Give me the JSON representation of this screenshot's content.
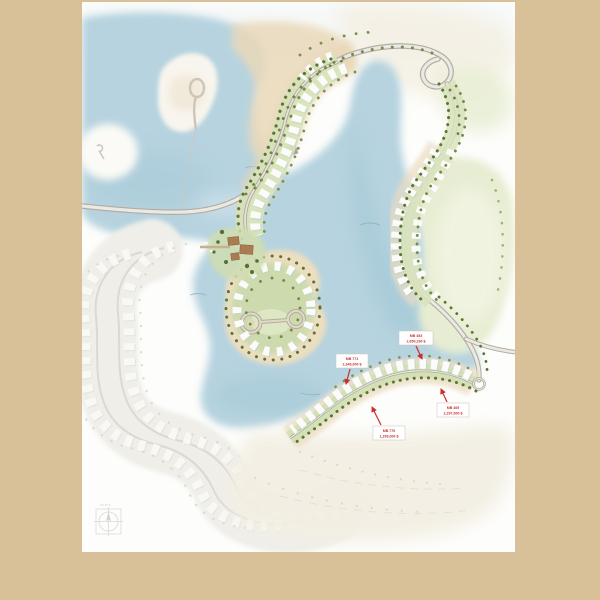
{
  "map": {
    "kind": "resort-master-plan",
    "palette": {
      "frame": "#d8c198",
      "sheet": "#fdfdfb",
      "water": "#b6d3df",
      "water_deep": "#a3c7d5",
      "sand": "#ead9ba",
      "green_band": "#d6e1ba",
      "golf": "#e7edd2",
      "road": "#b2ada3",
      "tree": "#5e7336",
      "ghost": "#efeee9",
      "label_red": "#c92f2f",
      "clubhouse_brown": "#a97c52"
    },
    "price_labels": [
      {
        "lot": "MB 453",
        "price": "2,650,290 $"
      },
      {
        "lot": "MB 771",
        "price": "2,349,000 $"
      },
      {
        "lot": "MB 770",
        "price": "1,299,000 $"
      },
      {
        "lot": "MB 469",
        "price": "2,297,000 $"
      }
    ],
    "compass": {
      "label": "NORTH"
    }
  }
}
